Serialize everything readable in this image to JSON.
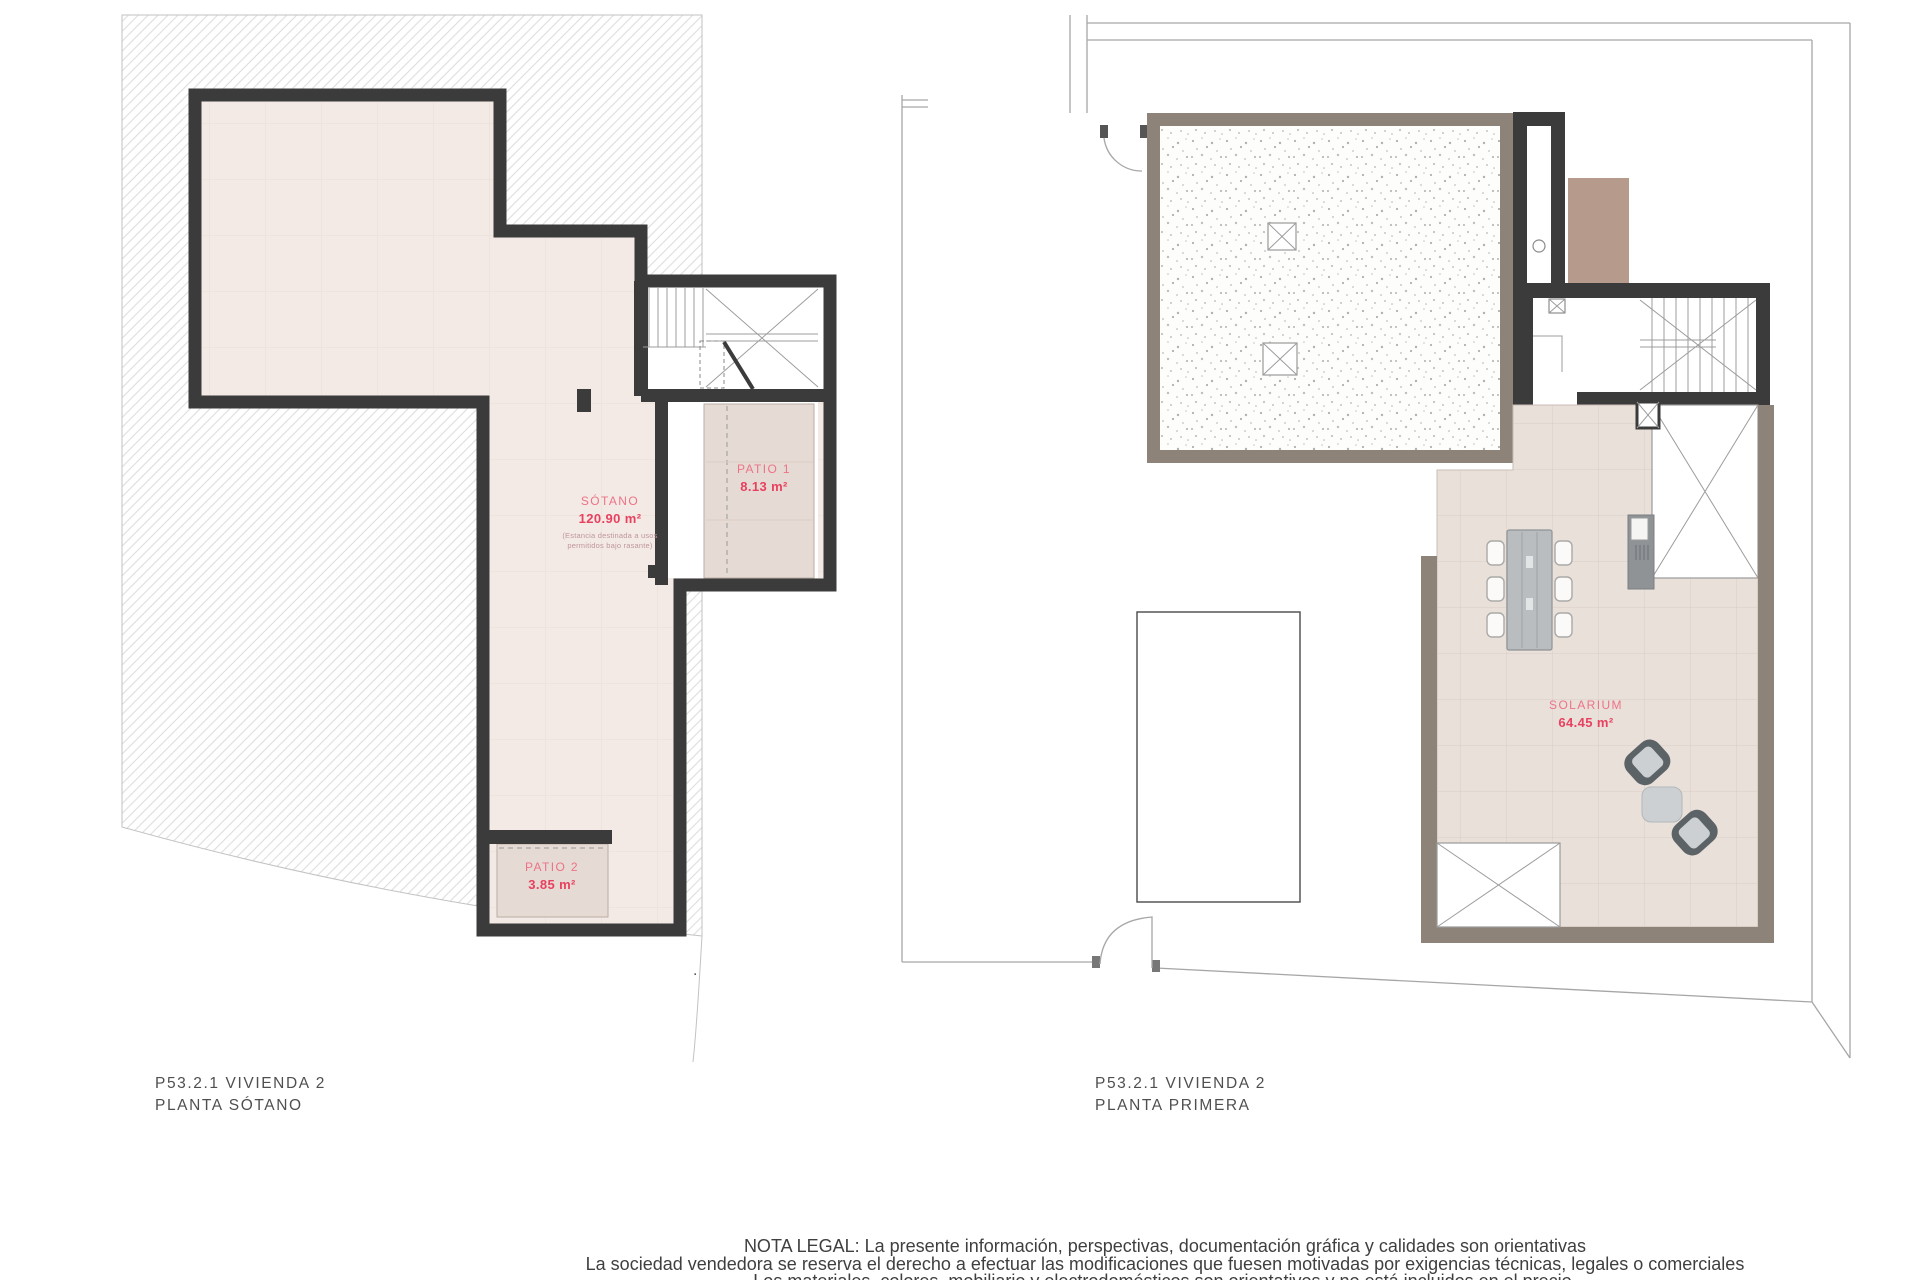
{
  "document": {
    "type": "floor-plan-sheet",
    "background": "#ffffff"
  },
  "colors": {
    "wall_dark": "#3b3b3c",
    "wall_taupe": "#8e8378",
    "room_fill": "#f3eae5",
    "patio_fill": "#e6dbd4",
    "tile_fill": "#eae0da",
    "tan_box": "#b69b8c",
    "label_pink": "#ed7287",
    "value_pink": "#e8405f",
    "boundary_gray": "#a6a6a6",
    "title_gray": "#4f4f4f"
  },
  "left_plan": {
    "title1": "P53.2.1 VIVIENDA 2",
    "title2": "PLANTA SÓTANO",
    "sotano": {
      "name": "SÓTANO",
      "area": "120.90 m²",
      "note1": "(Estancia destinada a usos",
      "note2": "permitidos bajo rasante)"
    },
    "patio1": {
      "name": "PATIO 1",
      "area": "8.13 m²"
    },
    "patio2": {
      "name": "PATIO 2",
      "area": "3.85 m²"
    }
  },
  "right_plan": {
    "title1": "P53.2.1 VIVIENDA 2",
    "title2": "PLANTA PRIMERA",
    "solarium": {
      "name": "SOLARIUM",
      "area": "64.45 m²"
    }
  },
  "separator_dot": ".",
  "legal": {
    "line1": "NOTA LEGAL: La presente información, perspectivas, documentación gráfica y calidades son orientativas",
    "line2": "La sociedad vendedora se reserva el derecho a efectuar las modificaciones que fuesen motivadas por exigencias técnicas, legales o comerciales",
    "line3": "Los materiales, colores, mobiliario y electrodomésticos son orientativos y no está incluidos en el precio."
  }
}
